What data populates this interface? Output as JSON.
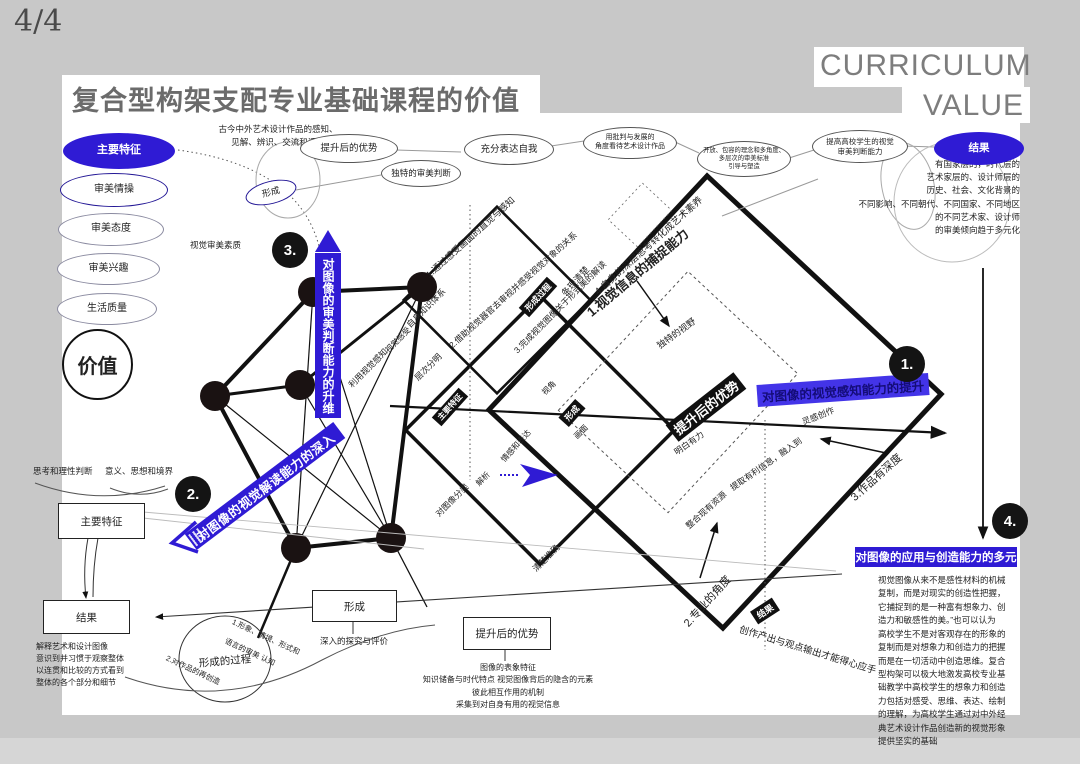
{
  "page": {
    "indicator": "4/4",
    "title": "复合型构架支配专业基础课程的价值",
    "brand_line1": "CURRICULUM",
    "brand_line2": "VALUE"
  },
  "colors": {
    "accent_blue": "#2f1bd4",
    "ink": "#222222",
    "canvas_gray": "#c8c8c8"
  },
  "left_column": {
    "ovals": [
      {
        "t": "主要特征",
        "x": 63,
        "y": 133,
        "w": 110,
        "h": 34,
        "fs": 11,
        "s": "blue"
      },
      {
        "t": "审美情操",
        "x": 60,
        "y": 173,
        "w": 106,
        "h": 32,
        "fs": 10,
        "s": "navy"
      },
      {
        "t": "审美态度",
        "x": 58,
        "y": 213,
        "w": 104,
        "h": 31,
        "fs": 10,
        "s": "thin"
      },
      {
        "t": "审美兴趣",
        "x": 57,
        "y": 253,
        "w": 101,
        "h": 30,
        "fs": 10,
        "s": "thin"
      },
      {
        "t": "生活质量",
        "x": 57,
        "y": 293,
        "w": 98,
        "h": 30,
        "fs": 10,
        "s": "thin"
      }
    ],
    "value_circle": "价值"
  },
  "top_flow": {
    "perception_note": "古今中外艺术设计作品的感知、\n见解、辨识、交流和评价",
    "quality_note": "视觉审美素质",
    "ovals": [
      {
        "t": "提升后的优势",
        "x": 300,
        "y": 134,
        "w": 96,
        "h": 27,
        "fs": 9.5,
        "s": "plain"
      },
      {
        "t": "形成",
        "x": 245,
        "y": 181,
        "w": 50,
        "h": 21,
        "fs": 9,
        "s": "navy",
        "r": -14
      },
      {
        "t": "独特的审美判断",
        "x": 381,
        "y": 160,
        "w": 78,
        "h": 25,
        "fs": 8.5,
        "s": "plain"
      },
      {
        "t": "充分表达自我",
        "x": 464,
        "y": 134,
        "w": 88,
        "h": 29,
        "fs": 9.5,
        "s": "plain"
      },
      {
        "t": "用批判与发展的\n角度看待艺术设计作品",
        "x": 583,
        "y": 127,
        "w": 92,
        "h": 30,
        "fs": 7,
        "s": "plain"
      },
      {
        "t": "开放、包容的理念和多角度、\n多层次的审美标准\n引导与塑造",
        "x": 697,
        "y": 141,
        "w": 92,
        "h": 34,
        "fs": 6.3,
        "s": "plain"
      },
      {
        "t": "提高高校学生的视觉\n审美判断能力",
        "x": 812,
        "y": 130,
        "w": 94,
        "h": 31,
        "fs": 7.5,
        "s": "plain"
      },
      {
        "t": "结果",
        "x": 934,
        "y": 132,
        "w": 88,
        "h": 31,
        "fs": 10.5,
        "s": "blue"
      }
    ],
    "result_paragraph": "有国家层的，时代层的\n艺术家层的、设计师层的\n历史、社会、文化背景的\n不同影响、不同朝代、不同国家、不同地区\n的不同艺术家、设计师\n的审美倾向趋于多元化"
  },
  "banners": {
    "judgement": "对图像的审美判断能力的升维",
    "interpretation": "对图像的视觉解读能力的深入",
    "perception": "对图像的视觉感知能力的提升",
    "creation": "对图像的应用与创造能力的多元"
  },
  "badges": [
    {
      "t": "1.",
      "x": 907,
      "y": 364
    },
    {
      "t": "2.",
      "x": 193,
      "y": 494
    },
    {
      "t": "3.",
      "x": 290,
      "y": 250
    },
    {
      "t": "4.",
      "x": 1010,
      "y": 521
    }
  ],
  "black_tags": [
    {
      "t": "形成过程",
      "x": 538,
      "y": 297,
      "r": -48,
      "fs": 8.5
    },
    {
      "t": "主要特征",
      "x": 450,
      "y": 407,
      "r": -48,
      "fs": 8
    },
    {
      "t": "形成",
      "x": 572,
      "y": 413,
      "r": -48,
      "fs": 8.5
    },
    {
      "t": "提升后的优势",
      "x": 706,
      "y": 407,
      "r": -38,
      "fs": 13
    },
    {
      "t": "结果",
      "x": 765,
      "y": 611,
      "r": -33,
      "fs": 9
    }
  ],
  "diagram_labels": [
    {
      "t": "1.通过感受画面的直觉与感知",
      "x": 470,
      "y": 237,
      "r": -42,
      "fs": 9
    },
    {
      "t": "2.借助视觉器官去审视并感受视觉对象的关系",
      "x": 513,
      "y": 290,
      "r": -42,
      "fs": 8.5
    },
    {
      "t": "3.完成视觉图像关于形式美的解读",
      "x": 560,
      "y": 307,
      "r": -45,
      "fs": 8.5
    },
    {
      "t": "4.自身的深层思考转化成艺术素养",
      "x": 648,
      "y": 245,
      "r": -42,
      "fs": 9.5
    },
    {
      "t": "条理清楚",
      "x": 575,
      "y": 281,
      "r": -48,
      "fs": 9
    },
    {
      "t": "自身知识体系",
      "x": 426,
      "y": 308,
      "r": -45,
      "fs": 8.5
    },
    {
      "t": "利用视觉感知",
      "x": 368,
      "y": 368,
      "r": -45,
      "fs": 8.5
    },
    {
      "t": "视觉感受",
      "x": 398,
      "y": 340,
      "r": -45,
      "fs": 8
    },
    {
      "t": "层次分明",
      "x": 428,
      "y": 367,
      "r": -45,
      "fs": 8.5
    },
    {
      "t": "对图像分类",
      "x": 452,
      "y": 500,
      "r": -45,
      "fs": 8.5
    },
    {
      "t": "解析",
      "x": 483,
      "y": 479,
      "r": -45,
      "fs": 8
    },
    {
      "t": "清楚准确",
      "x": 546,
      "y": 558,
      "r": -45,
      "fs": 8.5
    },
    {
      "t": "情感和表达",
      "x": 516,
      "y": 446,
      "r": -48,
      "fs": 8
    },
    {
      "t": "视角",
      "x": 549,
      "y": 388,
      "r": -45,
      "fs": 8
    },
    {
      "t": "画面",
      "x": 581,
      "y": 432,
      "r": -45,
      "fs": 8
    },
    {
      "t": "独特的视野",
      "x": 676,
      "y": 333,
      "r": -36,
      "fs": 9
    },
    {
      "t": "1.视觉信息的捕捉能力",
      "x": 637,
      "y": 272,
      "r": -40,
      "fs": 13,
      "fw": 600
    },
    {
      "t": "明白有力",
      "x": 689,
      "y": 443,
      "r": -35,
      "fs": 8.5
    },
    {
      "t": "提取有利信息，融入到",
      "x": 766,
      "y": 464,
      "r": -35,
      "fs": 8.5
    },
    {
      "t": "灵感创作",
      "x": 818,
      "y": 416,
      "r": -22,
      "fs": 8.5
    },
    {
      "t": "3.作品有深度",
      "x": 876,
      "y": 477,
      "r": -42,
      "fs": 11
    },
    {
      "t": "整合现有资源",
      "x": 706,
      "y": 510,
      "r": -42,
      "fs": 8.5
    },
    {
      "t": "2.专业的角度",
      "x": 707,
      "y": 601,
      "r": -48,
      "fs": 11
    },
    {
      "t": "创作产出与观点输出才能得心应手",
      "x": 808,
      "y": 649,
      "r": 17,
      "fs": 9.5
    }
  ],
  "bottom_left": {
    "think_label": "思考和理性判断",
    "meaning_label": "意义、思想和境界",
    "feature_box": "主要特征",
    "result_box": "结果",
    "result_note": "解释艺术和设计图像\n意识到并习惯于观察整体\n以连贯和比较的方式看到\n整体的各个部分和细节",
    "process_circle": {
      "title": "形成的过程",
      "item1": "1.形象、情境、形式和",
      "item1b": "语言的审美 认知",
      "item2": "2.对作品的再创造"
    },
    "form_box": "形成",
    "form_note": "深入的探究与评价"
  },
  "bottom_mid": {
    "advantage_box": "提升后的优势",
    "advantage_note": "图像的表象特征\n知识储备与时代特点  视觉图像背后的隐含的元素\n彼此相互作用的机制\n采集到对自身有用的视觉信息"
  },
  "bottom_right_paragraph": "视觉图像从来不是感性材料的机械\n复制，而是对现实的创造性把握，\n它捕捉到的是一种富有想象力、创\n造力和敏感性的美。”也可以认为\n高校学生不是对客观存在的形象的\n复制而是对想象力和创造力的把握\n而是在一切活动中创造思维。复合\n型构架可以极大地激发高校专业基\n础教学中高校学生的想象力和创造\n力包括对感受、思维、表达、绘制\n的理解，为高校学生通过对中外经\n典艺术设计作品创造新的视觉形象\n提供坚实的基础"
}
